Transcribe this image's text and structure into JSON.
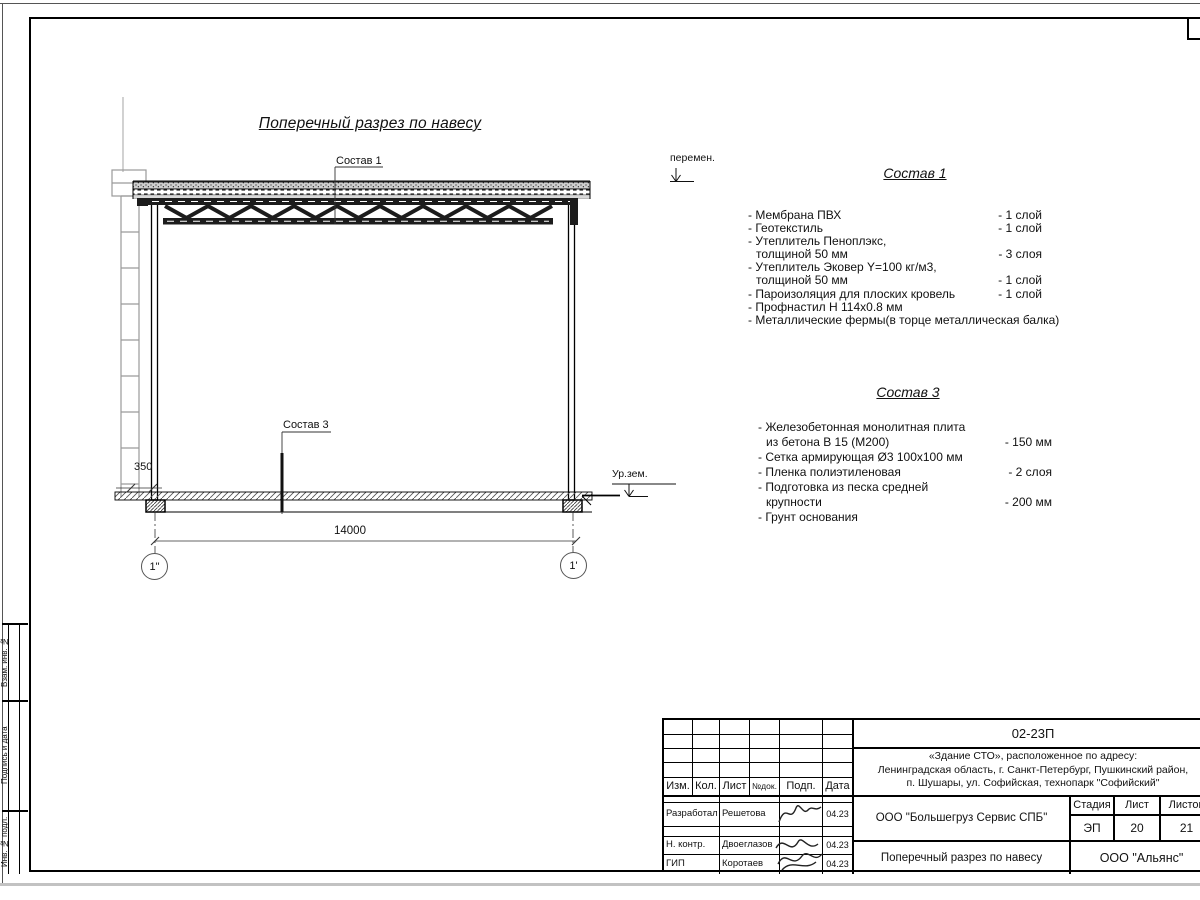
{
  "sheet": {
    "title": "Поперечный разрез по навесу"
  },
  "labels": {
    "sostav1_leader": "Состав 1",
    "sostav3_leader": "Состав 3",
    "peremen": "перемен.",
    "ur_zem": "Ур.зем.",
    "dim_350": "350",
    "dim_14000": "14000",
    "axis_left": "1\"",
    "axis_right": "1'"
  },
  "spec1": {
    "title": "Состав 1",
    "items": [
      {
        "text": "- Мембрана ПВХ",
        "value": "- 1 слой"
      },
      {
        "text": "- Геотекстиль",
        "value": "- 1 слой"
      },
      {
        "text": "- Утеплитель Пеноплэкс,",
        "value": ""
      },
      {
        "text": "толщиной 50 мм",
        "value": "- 3 слоя"
      },
      {
        "text": "- Утеплитель Эковер Y=100 кг/м3,",
        "value": ""
      },
      {
        "text": "толщиной 50 мм",
        "value": "- 1 слой"
      },
      {
        "text": "- Пароизоляция для плоских кровель",
        "value": "- 1 слой"
      },
      {
        "text": "- Профнастил Н 114х0.8 мм",
        "value": ""
      },
      {
        "text": "- Металлические фермы(в торце металлическая балка)",
        "value": ""
      }
    ]
  },
  "spec3": {
    "title": "Состав 3",
    "items": [
      {
        "text": "- Железобетонная  монолитная плита",
        "value": ""
      },
      {
        "text": "из бетона В 15 (М200)",
        "value": "- 150 мм"
      },
      {
        "text": "- Сетка армирующая Ø3 100х100 мм",
        "value": ""
      },
      {
        "text": "- Пленка полиэтиленовая",
        "value": "-  2 слоя"
      },
      {
        "text": "- Подготовка из песка средней",
        "value": ""
      },
      {
        "text": "крупности",
        "value": "- 200 мм"
      },
      {
        "text": "- Грунт основания",
        "value": ""
      }
    ]
  },
  "side_stamps": [
    "Взам. инв. №",
    "Подпись и дата",
    "Инв. № подл."
  ],
  "titleblock": {
    "doc_number": "02-23П",
    "address_lines": [
      "«Здание СТО», расположенное по адресу:",
      "Ленинградская область, г. Санкт-Петербург, Пушкинский район,",
      "п. Шушары, ул. Софийская, технопарк \"Софийский\""
    ],
    "header": {
      "izm": "Изм.",
      "kol": "Кол.",
      "list": "Лист",
      "ndok": "№док.",
      "podp": "Подп.",
      "data": "Дата"
    },
    "rows": [
      {
        "role": "Разработал",
        "name": "Решетова",
        "date": "04.23"
      },
      {
        "role": "Н. контр.",
        "name": "Двоеглазов",
        "date": "04.23"
      },
      {
        "role": "ГИП",
        "name": "Коротаев",
        "date": "04.23"
      }
    ],
    "company": "ООО \"Большегруз Сервис СПБ\"",
    "stage_label": "Стадия",
    "sheet_label": "Лист",
    "sheets_label": "Листов",
    "stage": "ЭП",
    "sheet": "20",
    "sheets": "21",
    "sheet_title": "Поперечный разрез по навесу",
    "org": "ООО \"Альянс\""
  }
}
